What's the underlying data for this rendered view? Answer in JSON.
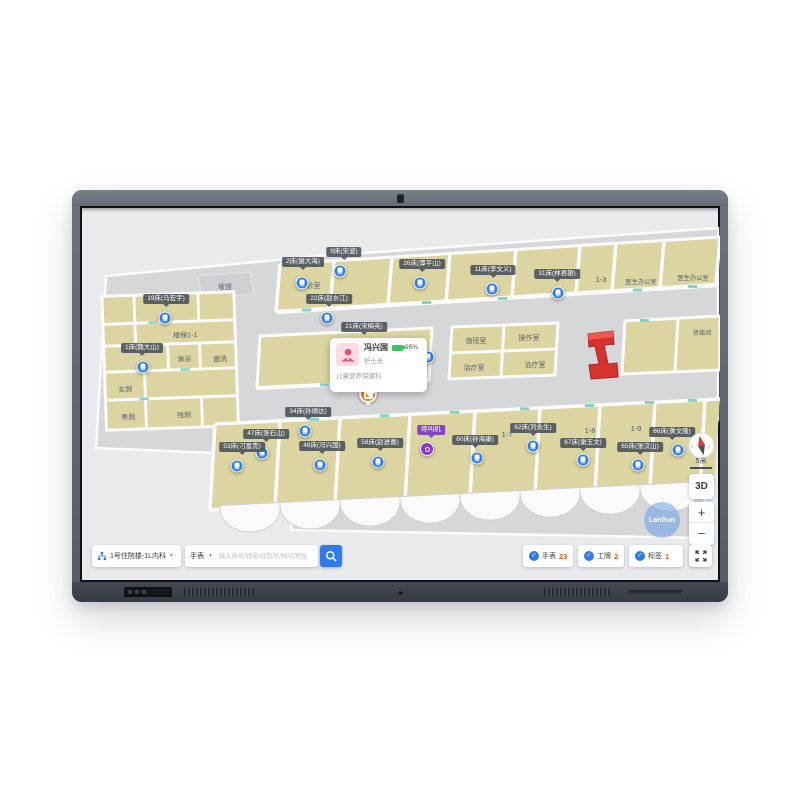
{
  "popup": {
    "name": "冯兴国",
    "battery": "95%",
    "role": "护士长",
    "department": "儿童营养保健科"
  },
  "controls": {
    "scale_label": "5米",
    "mode_label": "3D",
    "zoom_in_label": "+",
    "zoom_out_label": "−",
    "watermark": "LanBon"
  },
  "toolbar": {
    "area_selector": "1号住院楼-1L内科",
    "device_filter": "手表",
    "search_placeholder": "输入床号/姓名/住院号/MAC地址",
    "chips": [
      {
        "label": "手表",
        "count": "23"
      },
      {
        "label": "工牌",
        "count": "2"
      },
      {
        "label": "标签",
        "count": "1"
      }
    ]
  },
  "map": {
    "rooms": [
      {
        "label": "坡道"
      },
      {
        "label": "门厅"
      },
      {
        "label": "楼梯1-1"
      },
      {
        "label": "淋浴"
      },
      {
        "label": "盥洗"
      },
      {
        "label": "女厕"
      },
      {
        "label": "男厕"
      },
      {
        "label": "残厕"
      },
      {
        "label": "候诊室"
      },
      {
        "label": "值班室"
      },
      {
        "label": "操作室"
      },
      {
        "label": "治疗室"
      },
      {
        "label": "治疗室"
      },
      {
        "label": "扶梯1-1"
      },
      {
        "label": "货梯间"
      },
      {
        "label": "医生办公室"
      },
      {
        "label": "医生办公室"
      },
      {
        "label": "1-3"
      },
      {
        "label": "1-5"
      },
      {
        "label": "1-7"
      },
      {
        "label": "1-8"
      },
      {
        "label": "1-9"
      }
    ],
    "bed_tags": [
      {
        "label": "19床(马宏宇)",
        "tx": 86,
        "ty": 88,
        "mx": 85,
        "my": 112
      },
      {
        "label": "1床(魏大山)",
        "tx": 62,
        "ty": 137,
        "mx": 63,
        "my": 161
      },
      {
        "label": "2床(谢大海)",
        "tx": 223,
        "ty": 51,
        "mx": 222,
        "my": 77
      },
      {
        "label": "9床(宋波)",
        "tx": 264,
        "ty": 41,
        "mx": 260,
        "my": 65
      },
      {
        "label": "22床(赵水江)",
        "tx": 249,
        "ty": 88,
        "mx": 247,
        "my": 112
      },
      {
        "label": "26床(谭平山)",
        "tx": 342,
        "ty": 53,
        "mx": 340,
        "my": 77
      },
      {
        "label": "11床(李文义)",
        "tx": 413,
        "ty": 59,
        "mx": 412,
        "my": 83
      },
      {
        "label": "31床(林君雄)",
        "tx": 477,
        "ty": 63,
        "mx": 478,
        "my": 87
      },
      {
        "label": "21床(宋梅英)",
        "tx": 284,
        "ty": 116,
        "mx": 348,
        "my": 151
      },
      {
        "label": "34床(孙顺达)",
        "tx": 228,
        "ty": 201,
        "mx": 225,
        "my": 225
      },
      {
        "label": "47床(张石山)",
        "tx": 186,
        "ty": 223,
        "mx": 182,
        "my": 247
      },
      {
        "label": "53床(刁富贵)",
        "tx": 162,
        "ty": 236,
        "mx": 157,
        "my": 260
      },
      {
        "label": "48床(冯兴国)",
        "tx": 242,
        "ty": 235,
        "mx": 240,
        "my": 259
      },
      {
        "label": "58床(赵进喜)",
        "tx": 300,
        "ty": 232,
        "mx": 298,
        "my": 256
      },
      {
        "label": "60床(孙海康)",
        "tx": 395,
        "ty": 229,
        "mx": 397,
        "my": 252
      },
      {
        "label": "62床(刘永生)",
        "tx": 453,
        "ty": 217,
        "mx": 453,
        "my": 240
      },
      {
        "label": "67床(谢玉文)",
        "tx": 503,
        "ty": 232,
        "mx": 503,
        "my": 254
      },
      {
        "label": "65床(张汉山)",
        "tx": 560,
        "ty": 236,
        "mx": 558,
        "my": 259
      },
      {
        "label": "66床(黄文隆)",
        "tx": 592,
        "ty": 221,
        "mx": 598,
        "my": 244
      }
    ],
    "call_device": {
      "label": "呼叫机",
      "tx": 351,
      "ty": 219,
      "mx": 347,
      "my": 243
    },
    "person_marker": {
      "x": 288,
      "y": 188
    }
  }
}
